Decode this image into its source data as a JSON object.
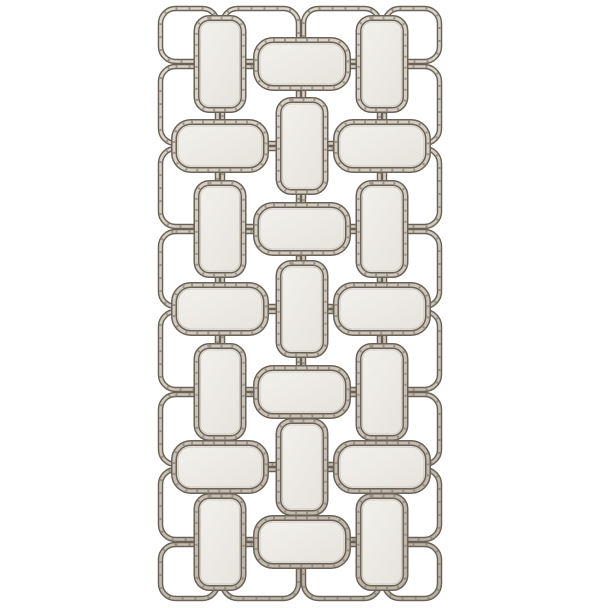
{
  "scene": {
    "description": "Product photo of a tall rectangular champagne-silver metal wall mirror: an openwork lattice of interlocking rounded rectangles holding 21 small antiqued mirror panels arranged in an alternating vertical/horizontal basketweave pattern, photographed on a plain white background.",
    "background_color": "#ffffff",
    "palette": {
      "metal_dark": "#6b6257",
      "metal_light_top": "#ddd7cd",
      "metal_light_mid": "#cfc8bd",
      "metal_light_bottom": "#b9b0a4",
      "metal_speckle": "#877e72",
      "glass_light": "#f3f1ed",
      "glass_dark": "#e6e3dc",
      "glass_inner_edge": "#c9c3b9"
    },
    "lattice": {
      "column_lines": [
        158,
        220,
        301,
        382,
        442
      ],
      "row_lines": [
        6,
        64,
        146,
        229,
        309,
        392,
        467,
        542,
        601
      ],
      "cell_inset": 2.5,
      "cell_corner_radius": 15,
      "tube_dark_width": 5.5,
      "tube_light_width": 2.6,
      "open_cell_count": 32
    },
    "mirrors": {
      "column_centers": [
        220,
        302,
        382
      ],
      "band_centers": [
        64,
        146,
        229,
        309,
        392,
        467,
        542
      ],
      "vertical_panel": {
        "width": 47,
        "height": 92,
        "corner_radius": 13
      },
      "horizontal_panel": {
        "width": 92,
        "height": 48,
        "corner_radius": 17
      },
      "pattern": [
        [
          "V",
          "H",
          "V"
        ],
        [
          "H",
          "V",
          "H"
        ],
        [
          "V",
          "H",
          "V"
        ],
        [
          "H",
          "V",
          "H"
        ],
        [
          "V",
          "H",
          "V"
        ],
        [
          "H",
          "V",
          "H"
        ],
        [
          "V",
          "H",
          "V"
        ]
      ],
      "panel_count": 21
    }
  }
}
